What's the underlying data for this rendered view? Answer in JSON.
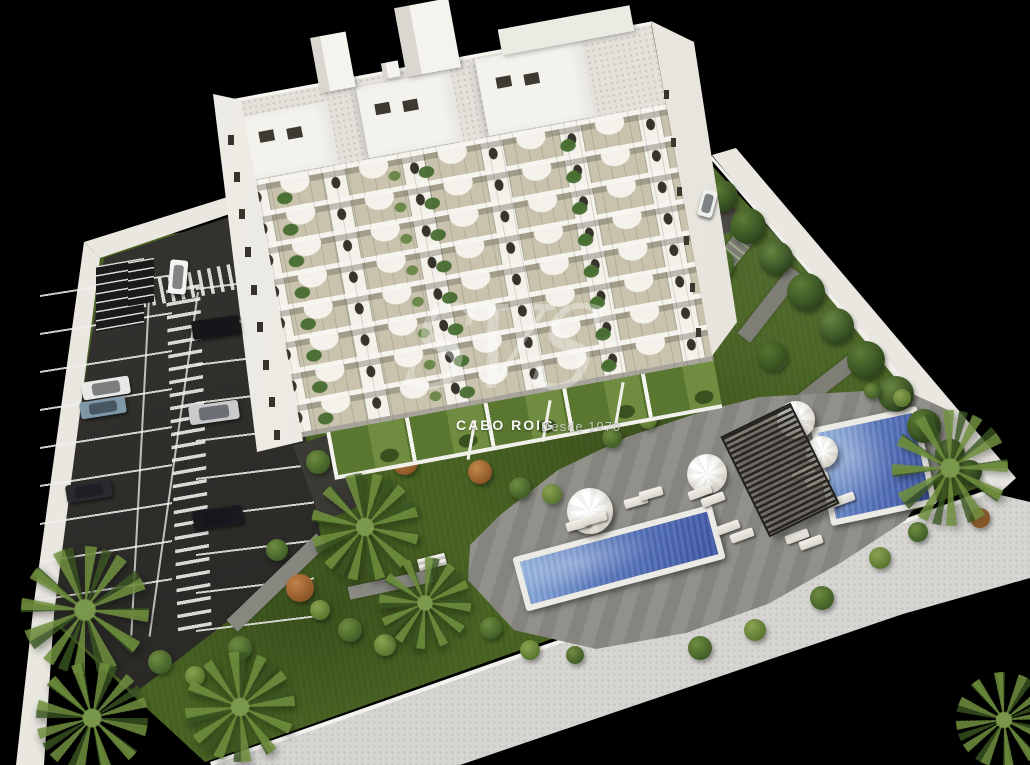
{
  "scene": {
    "type": "3d-architectural-aerial-render",
    "subject": "White apartment building with landscaped garden, two swimming pools, pergola and parking lot on black background",
    "counts": {
      "facade_floors": 8,
      "pools": 2,
      "parked_cars": 8,
      "umbrellas": 4
    }
  },
  "watermark": {
    "monogram": "SVS",
    "brand": "CABO ROIG",
    "tagline": "Desde 1970"
  },
  "palette": {
    "background": "#000000",
    "building_white": "#f3f1ea",
    "balcony_beige": "#c9c3ad",
    "grass_green": "#4a6524",
    "asphalt_dark": "#2e2d2a",
    "pool_blue": "#4e70b6",
    "deck_gray": "#8c8b85",
    "wall_light": "#e9e7e0",
    "pergola_dark": "#26241e"
  }
}
